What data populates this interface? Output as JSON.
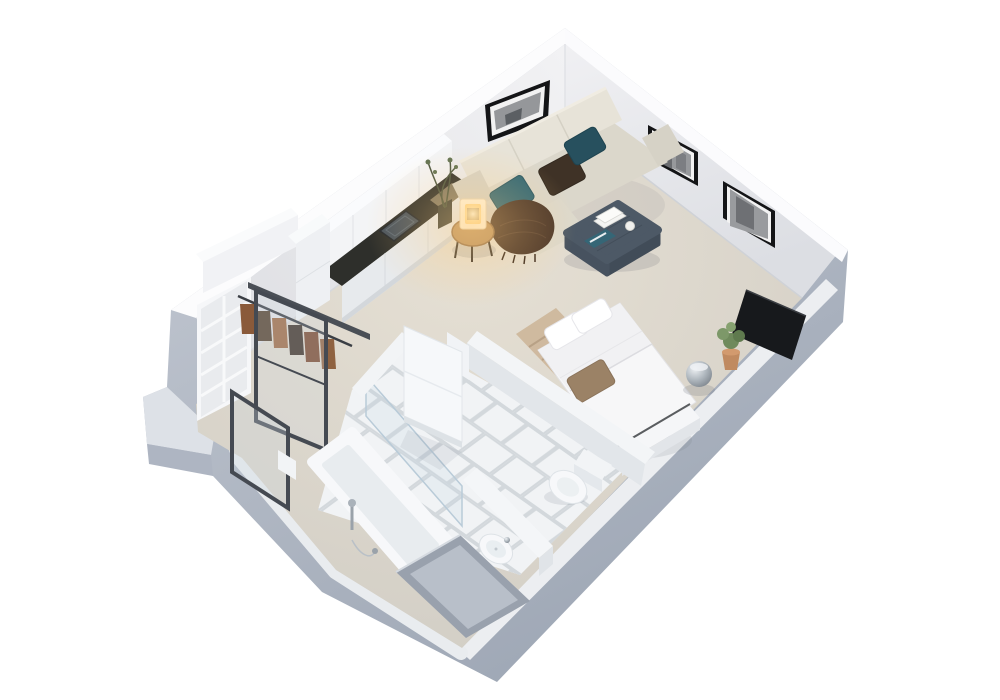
{
  "scene": {
    "type": "3d-floorplan-render",
    "description": "Isometric 3D cutaway render of a studio apartment floor plan on a white background: living corner with sofa and wall art, kitchenette, wardrobe with sliding glass doors, bed with TV, and a tiled bathroom with tub, basin and toilet.",
    "rooms": [
      {
        "name": "living-area",
        "furniture": [
          "corner-sofa",
          "teal-pillow",
          "dark-teal-pillow",
          "brown-pillow",
          "fringed-throw",
          "ottoman-coffee-table",
          "books",
          "white-vase",
          "magazine",
          "round-side-table",
          "table-lamp",
          "wall-art-panorama",
          "wall-art-portrait-1",
          "wall-art-portrait-2"
        ]
      },
      {
        "name": "kitchenette",
        "furniture": [
          "upper-cabinets",
          "tall-cabinet",
          "dark-countertop",
          "cooktop",
          "base-cabinets",
          "twig-vase-plant"
        ]
      },
      {
        "name": "sleeping-area",
        "furniture": [
          "double-bed",
          "white-pillows",
          "accent-pillow",
          "foot-bench",
          "tan-rug",
          "tv-panel",
          "potted-plant",
          "chrome-stool"
        ]
      },
      {
        "name": "wardrobe",
        "furniture": [
          "shelving-unit",
          "clothes-rail",
          "hanging-clothes",
          "sliding-glass-door-closed",
          "sliding-glass-door-open"
        ]
      },
      {
        "name": "bathroom",
        "furniture": [
          "bathtub",
          "shower-fixture",
          "glass-screen",
          "open-door",
          "vanity-partition",
          "washbasin",
          "toilet",
          "tiled-floor",
          "recessed-niche"
        ]
      }
    ],
    "colors": {
      "background": "#ffffff",
      "exterior_wall": "#aab2c0",
      "wall_top_strip": "#eceef1",
      "step_top": "#dde1e7",
      "step_face": "#aeb5c2",
      "wall_interior": "#ededf0",
      "carpet": "#d8d3c9",
      "tile": "#f1f3f5",
      "tile_grout": "#d3d8dc",
      "porcelain": "#f7f8fa",
      "porcelain_shade": "#e8ecef",
      "low_wall_top": "#f3f5f7",
      "low_wall_face": "#e2e6ea",
      "niche_outer": "#99a1ad",
      "niche_inner": "#b8bfc9",
      "sofa_base": "#dbd7cb",
      "sofa_back": "#e7e3d8",
      "sofa_arm": "#d6d2c6",
      "pillow_teal": "#2e6675",
      "pillow_dark_teal": "#27505e",
      "pillow_brown": "#3f3226",
      "throw": "#4a3528",
      "ottoman_top": "#4d5966",
      "ottoman_side": "#414c58",
      "magazine": "#356676",
      "table_wood": "#bb9260",
      "lamp_body": "#fff4de",
      "lamp_glow": "#ffd98f",
      "counter": "#2e2f2b",
      "cooktop": "#47525d",
      "cabinet": "#f3f4f6",
      "cabinet_base": "#e7eaed",
      "bed_linen": "#f7f7f8",
      "bed_accent_pillow": "#9b8266",
      "rug_tan": "#cdb79c",
      "tv": "#17191c",
      "plant_green": "#6f8a5c",
      "pot_terracotta": "#c08a60",
      "door_frame": "#454a52",
      "frame_black": "#141517",
      "photo_gray": "#95979a",
      "clothes": [
        "#8a5a3a",
        "#54422f",
        "#9c6a45",
        "#3f332a",
        "#7a4a30",
        "#8f6240"
      ]
    }
  }
}
